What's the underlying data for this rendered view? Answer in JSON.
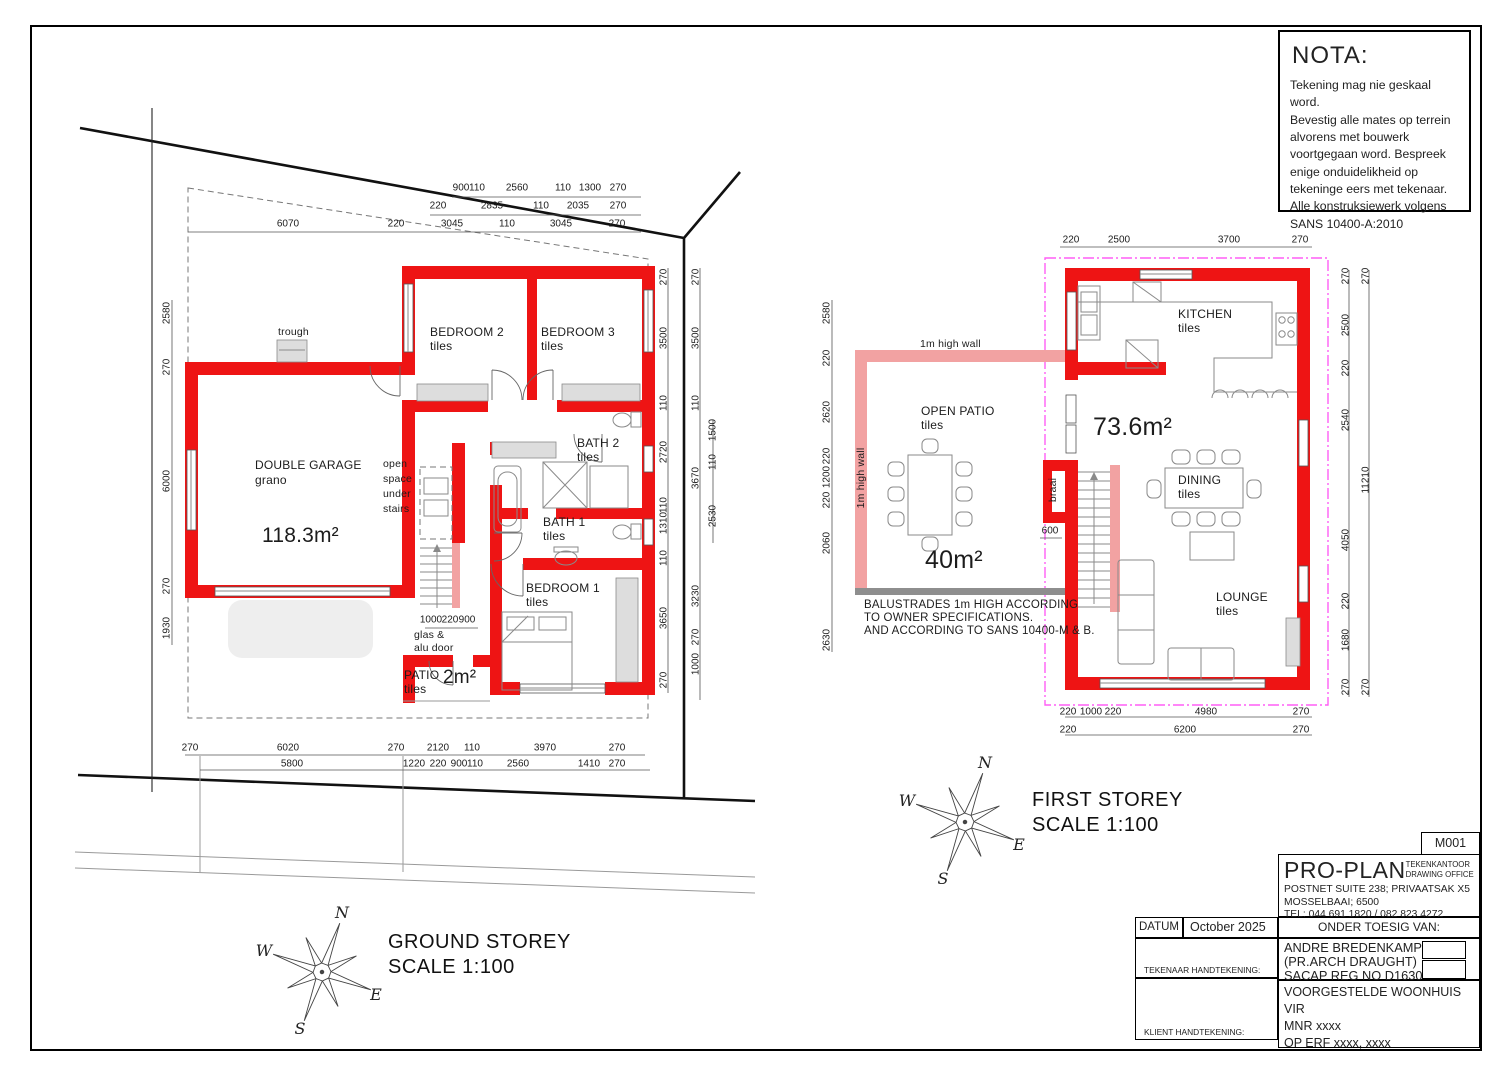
{
  "colors": {
    "wall_red": "#ee1414",
    "wall_pink": "#f2a2a2",
    "envelope_magenta": "#ff5ff5",
    "balustrade_gray": "#8e8e8e"
  },
  "nota": {
    "title": "NOTA:",
    "lines": [
      "Tekening mag nie geskaal word.",
      "Bevestig alle mates op terrein",
      "alvorens met bouwerk",
      "voortgegaan word.  Bespreek",
      "enige onduidelikheid op",
      "tekeninge eers met tekenaar.",
      "Alle konstruksiewerk volgens",
      "SANS 10400-A:2010"
    ]
  },
  "plan_titles": {
    "ground_line1": "GROUND STOREY",
    "ground_line2": "SCALE 1:100",
    "first_line1": "FIRST STOREY",
    "first_line2": "SCALE 1:100"
  },
  "compass": {
    "n": "N",
    "e": "E",
    "s": "S",
    "w": "W"
  },
  "title_block": {
    "sheet_no": "M001",
    "company": "PRO-PLAN",
    "company_sub1": "TEKENKANTOOR",
    "company_sub2": "DRAWING OFFICE",
    "address1": "POSTNET SUITE 238; PRIVAATSAK X5",
    "address2": "MOSSELBAAI; 6500",
    "tel": "TEL: 044 691 1820 / 082 823 4272",
    "datum_label": "DATUM",
    "datum_value": "October 2025",
    "supervision_label": "ONDER TOESIG VAN:",
    "architect1": "ANDRE BREDENKAMP",
    "architect2": "(PR.ARCH DRAUGHT)",
    "architect3": "SACAP REG NO D1630",
    "sig1_label": "TEKENAAR HANDTEKENING:",
    "sig2_label": "KLIENT HANDTEKENING:",
    "project1": "VOORGESTELDE WOONHUIS VIR",
    "project2": "MNR xxxx",
    "project3": "OP ERF xxxx, xxxx"
  },
  "labels": [
    {
      "x": 278,
      "y": 326,
      "t": "trough",
      "cls": "small"
    },
    {
      "x": 430,
      "y": 325,
      "t": "BEDROOM 2"
    },
    {
      "x": 430,
      "y": 339,
      "t": "tiles"
    },
    {
      "x": 541,
      "y": 325,
      "t": "BEDROOM 3"
    },
    {
      "x": 541,
      "y": 339,
      "t": "tiles"
    },
    {
      "x": 255,
      "y": 458,
      "t": "DOUBLE GARAGE"
    },
    {
      "x": 255,
      "y": 473,
      "t": "grano"
    },
    {
      "x": 262,
      "y": 524,
      "t": "118.3m²",
      "cls": "area"
    },
    {
      "x": 383,
      "y": 458,
      "t": "open",
      "cls": "small"
    },
    {
      "x": 383,
      "y": 473,
      "t": "space",
      "cls": "small"
    },
    {
      "x": 383,
      "y": 488,
      "t": "under",
      "cls": "small"
    },
    {
      "x": 383,
      "y": 503,
      "t": "stairs",
      "cls": "small"
    },
    {
      "x": 577,
      "y": 436,
      "t": "BATH 2"
    },
    {
      "x": 577,
      "y": 450,
      "t": "tiles"
    },
    {
      "x": 543,
      "y": 515,
      "t": "BATH 1"
    },
    {
      "x": 543,
      "y": 529,
      "t": "tiles"
    },
    {
      "x": 526,
      "y": 581,
      "t": "BEDROOM 1"
    },
    {
      "x": 526,
      "y": 595,
      "t": "tiles"
    },
    {
      "x": 414,
      "y": 629,
      "t": "glas &",
      "cls": "small"
    },
    {
      "x": 414,
      "y": 642,
      "t": "alu door",
      "cls": "small"
    },
    {
      "x": 404,
      "y": 668,
      "t": "PATIO"
    },
    {
      "x": 404,
      "y": 682,
      "t": "tiles"
    },
    {
      "x": 443,
      "y": 667,
      "t": "2m²",
      "cls": "area-sm"
    },
    {
      "x": 1178,
      "y": 307,
      "t": "KITCHEN"
    },
    {
      "x": 1178,
      "y": 321,
      "t": "tiles"
    },
    {
      "x": 920,
      "y": 338,
      "t": "1m high wall",
      "cls": "small"
    },
    {
      "x": 861,
      "y": 478,
      "t": "1m high wall",
      "cls": "small",
      "r": -90
    },
    {
      "x": 921,
      "y": 404,
      "t": "OPEN PATIO"
    },
    {
      "x": 921,
      "y": 418,
      "t": "tiles"
    },
    {
      "x": 1093,
      "y": 413,
      "t": "73.6m²",
      "cls": "area-lg"
    },
    {
      "x": 1053,
      "y": 490,
      "t": "braai",
      "cls": "small",
      "r": -90
    },
    {
      "x": 1178,
      "y": 473,
      "t": "DINING"
    },
    {
      "x": 1178,
      "y": 487,
      "t": "tiles"
    },
    {
      "x": 1216,
      "y": 590,
      "t": "LOUNGE"
    },
    {
      "x": 1216,
      "y": 604,
      "t": "tiles"
    },
    {
      "x": 925,
      "y": 546,
      "t": "40m²",
      "cls": "area-lg"
    },
    {
      "x": 864,
      "y": 599,
      "t": "BALUSTRADES 1m HIGH ACCORDING",
      "cls": "note"
    },
    {
      "x": 864,
      "y": 612,
      "t": "TO OWNER SPECIFICATIONS.",
      "cls": "note"
    },
    {
      "x": 864,
      "y": 625,
      "t": "AND ACCORDING TO SANS 10400-M & B.",
      "cls": "note"
    }
  ],
  "dims": [
    {
      "x": 461,
      "y": 188,
      "t": "900"
    },
    {
      "x": 477,
      "y": 188,
      "t": "110"
    },
    {
      "x": 517,
      "y": 188,
      "t": "2560"
    },
    {
      "x": 563,
      "y": 188,
      "t": "110"
    },
    {
      "x": 590,
      "y": 188,
      "t": "1300"
    },
    {
      "x": 618,
      "y": 188,
      "t": "270"
    },
    {
      "x": 438,
      "y": 206,
      "t": "220"
    },
    {
      "x": 492,
      "y": 206,
      "t": "2835"
    },
    {
      "x": 541,
      "y": 206,
      "t": "110"
    },
    {
      "x": 578,
      "y": 206,
      "t": "2035"
    },
    {
      "x": 618,
      "y": 206,
      "t": "270"
    },
    {
      "x": 288,
      "y": 224,
      "t": "6070"
    },
    {
      "x": 396,
      "y": 224,
      "t": "220"
    },
    {
      "x": 452,
      "y": 224,
      "t": "3045"
    },
    {
      "x": 507,
      "y": 224,
      "t": "110"
    },
    {
      "x": 561,
      "y": 224,
      "t": "3045"
    },
    {
      "x": 617,
      "y": 224,
      "t": "270"
    },
    {
      "x": 190,
      "y": 748,
      "t": "270"
    },
    {
      "x": 288,
      "y": 748,
      "t": "6020"
    },
    {
      "x": 396,
      "y": 748,
      "t": "270"
    },
    {
      "x": 438,
      "y": 748,
      "t": "2120"
    },
    {
      "x": 472,
      "y": 748,
      "t": "110"
    },
    {
      "x": 545,
      "y": 748,
      "t": "3970"
    },
    {
      "x": 617,
      "y": 748,
      "t": "270"
    },
    {
      "x": 292,
      "y": 764,
      "t": "5800"
    },
    {
      "x": 414,
      "y": 764,
      "t": "1220"
    },
    {
      "x": 438,
      "y": 764,
      "t": "220"
    },
    {
      "x": 459,
      "y": 764,
      "t": "900"
    },
    {
      "x": 475,
      "y": 764,
      "t": "110"
    },
    {
      "x": 518,
      "y": 764,
      "t": "2560"
    },
    {
      "x": 589,
      "y": 764,
      "t": "1410"
    },
    {
      "x": 617,
      "y": 764,
      "t": "270"
    },
    {
      "x": 167,
      "y": 313,
      "t": "2580",
      "r": -90
    },
    {
      "x": 167,
      "y": 367,
      "t": "270",
      "r": -90
    },
    {
      "x": 167,
      "y": 481,
      "t": "6000",
      "r": -90
    },
    {
      "x": 167,
      "y": 586,
      "t": "270",
      "r": -90
    },
    {
      "x": 167,
      "y": 628,
      "t": "1930",
      "r": -90
    },
    {
      "x": 664,
      "y": 277,
      "t": "270",
      "r": -90
    },
    {
      "x": 664,
      "y": 338,
      "t": "3500",
      "r": -90
    },
    {
      "x": 664,
      "y": 403,
      "t": "110",
      "r": -90
    },
    {
      "x": 664,
      "y": 452,
      "t": "2720",
      "r": -90
    },
    {
      "x": 664,
      "y": 505,
      "t": "110",
      "r": -90
    },
    {
      "x": 664,
      "y": 523,
      "t": "1310",
      "r": -90
    },
    {
      "x": 664,
      "y": 558,
      "t": "110",
      "r": -90
    },
    {
      "x": 664,
      "y": 618,
      "t": "3650",
      "r": -90
    },
    {
      "x": 664,
      "y": 680,
      "t": "270",
      "r": -90
    },
    {
      "x": 696,
      "y": 277,
      "t": "270",
      "r": -90
    },
    {
      "x": 696,
      "y": 338,
      "t": "3500",
      "r": -90
    },
    {
      "x": 696,
      "y": 403,
      "t": "110",
      "r": -90
    },
    {
      "x": 696,
      "y": 478,
      "t": "3670",
      "r": -90
    },
    {
      "x": 696,
      "y": 596,
      "t": "3230",
      "r": -90
    },
    {
      "x": 696,
      "y": 637,
      "t": "270",
      "r": -90
    },
    {
      "x": 696,
      "y": 664,
      "t": "1000",
      "r": -90
    },
    {
      "x": 713,
      "y": 430,
      "t": "1500",
      "r": -90
    },
    {
      "x": 713,
      "y": 462,
      "t": "110",
      "r": -90
    },
    {
      "x": 713,
      "y": 516,
      "t": "2530",
      "r": -90
    },
    {
      "x": 431,
      "y": 620,
      "t": "1000"
    },
    {
      "x": 450,
      "y": 620,
      "t": "220"
    },
    {
      "x": 467,
      "y": 620,
      "t": "900"
    },
    {
      "x": 1071,
      "y": 240,
      "t": "220"
    },
    {
      "x": 1119,
      "y": 240,
      "t": "2500"
    },
    {
      "x": 1229,
      "y": 240,
      "t": "3700"
    },
    {
      "x": 1300,
      "y": 240,
      "t": "270"
    },
    {
      "x": 1068,
      "y": 712,
      "t": "220"
    },
    {
      "x": 1091,
      "y": 712,
      "t": "1000"
    },
    {
      "x": 1113,
      "y": 712,
      "t": "220"
    },
    {
      "x": 1206,
      "y": 712,
      "t": "4980"
    },
    {
      "x": 1301,
      "y": 712,
      "t": "270"
    },
    {
      "x": 1068,
      "y": 730,
      "t": "220"
    },
    {
      "x": 1185,
      "y": 730,
      "t": "6200"
    },
    {
      "x": 1301,
      "y": 730,
      "t": "270"
    },
    {
      "x": 827,
      "y": 313,
      "t": "2580",
      "r": -90
    },
    {
      "x": 827,
      "y": 358,
      "t": "220",
      "r": -90
    },
    {
      "x": 827,
      "y": 412,
      "t": "2620",
      "r": -90
    },
    {
      "x": 827,
      "y": 456,
      "t": "220",
      "r": -90
    },
    {
      "x": 827,
      "y": 477,
      "t": "1200",
      "r": -90
    },
    {
      "x": 827,
      "y": 500,
      "t": "220",
      "r": -90
    },
    {
      "x": 827,
      "y": 543,
      "t": "2060",
      "r": -90
    },
    {
      "x": 827,
      "y": 640,
      "t": "2630",
      "r": -90
    },
    {
      "x": 1346,
      "y": 276,
      "t": "270",
      "r": -90
    },
    {
      "x": 1346,
      "y": 325,
      "t": "2500",
      "r": -90
    },
    {
      "x": 1346,
      "y": 368,
      "t": "220",
      "r": -90
    },
    {
      "x": 1346,
      "y": 420,
      "t": "2540",
      "r": -90
    },
    {
      "x": 1346,
      "y": 540,
      "t": "4050",
      "r": -90
    },
    {
      "x": 1346,
      "y": 601,
      "t": "220",
      "r": -90
    },
    {
      "x": 1346,
      "y": 640,
      "t": "1680",
      "r": -90
    },
    {
      "x": 1346,
      "y": 687,
      "t": "270",
      "r": -90
    },
    {
      "x": 1366,
      "y": 276,
      "t": "270",
      "r": -90
    },
    {
      "x": 1366,
      "y": 480,
      "t": "11210",
      "r": -90
    },
    {
      "x": 1366,
      "y": 687,
      "t": "270",
      "r": -90
    },
    {
      "x": 1050,
      "y": 531,
      "t": "600"
    }
  ]
}
